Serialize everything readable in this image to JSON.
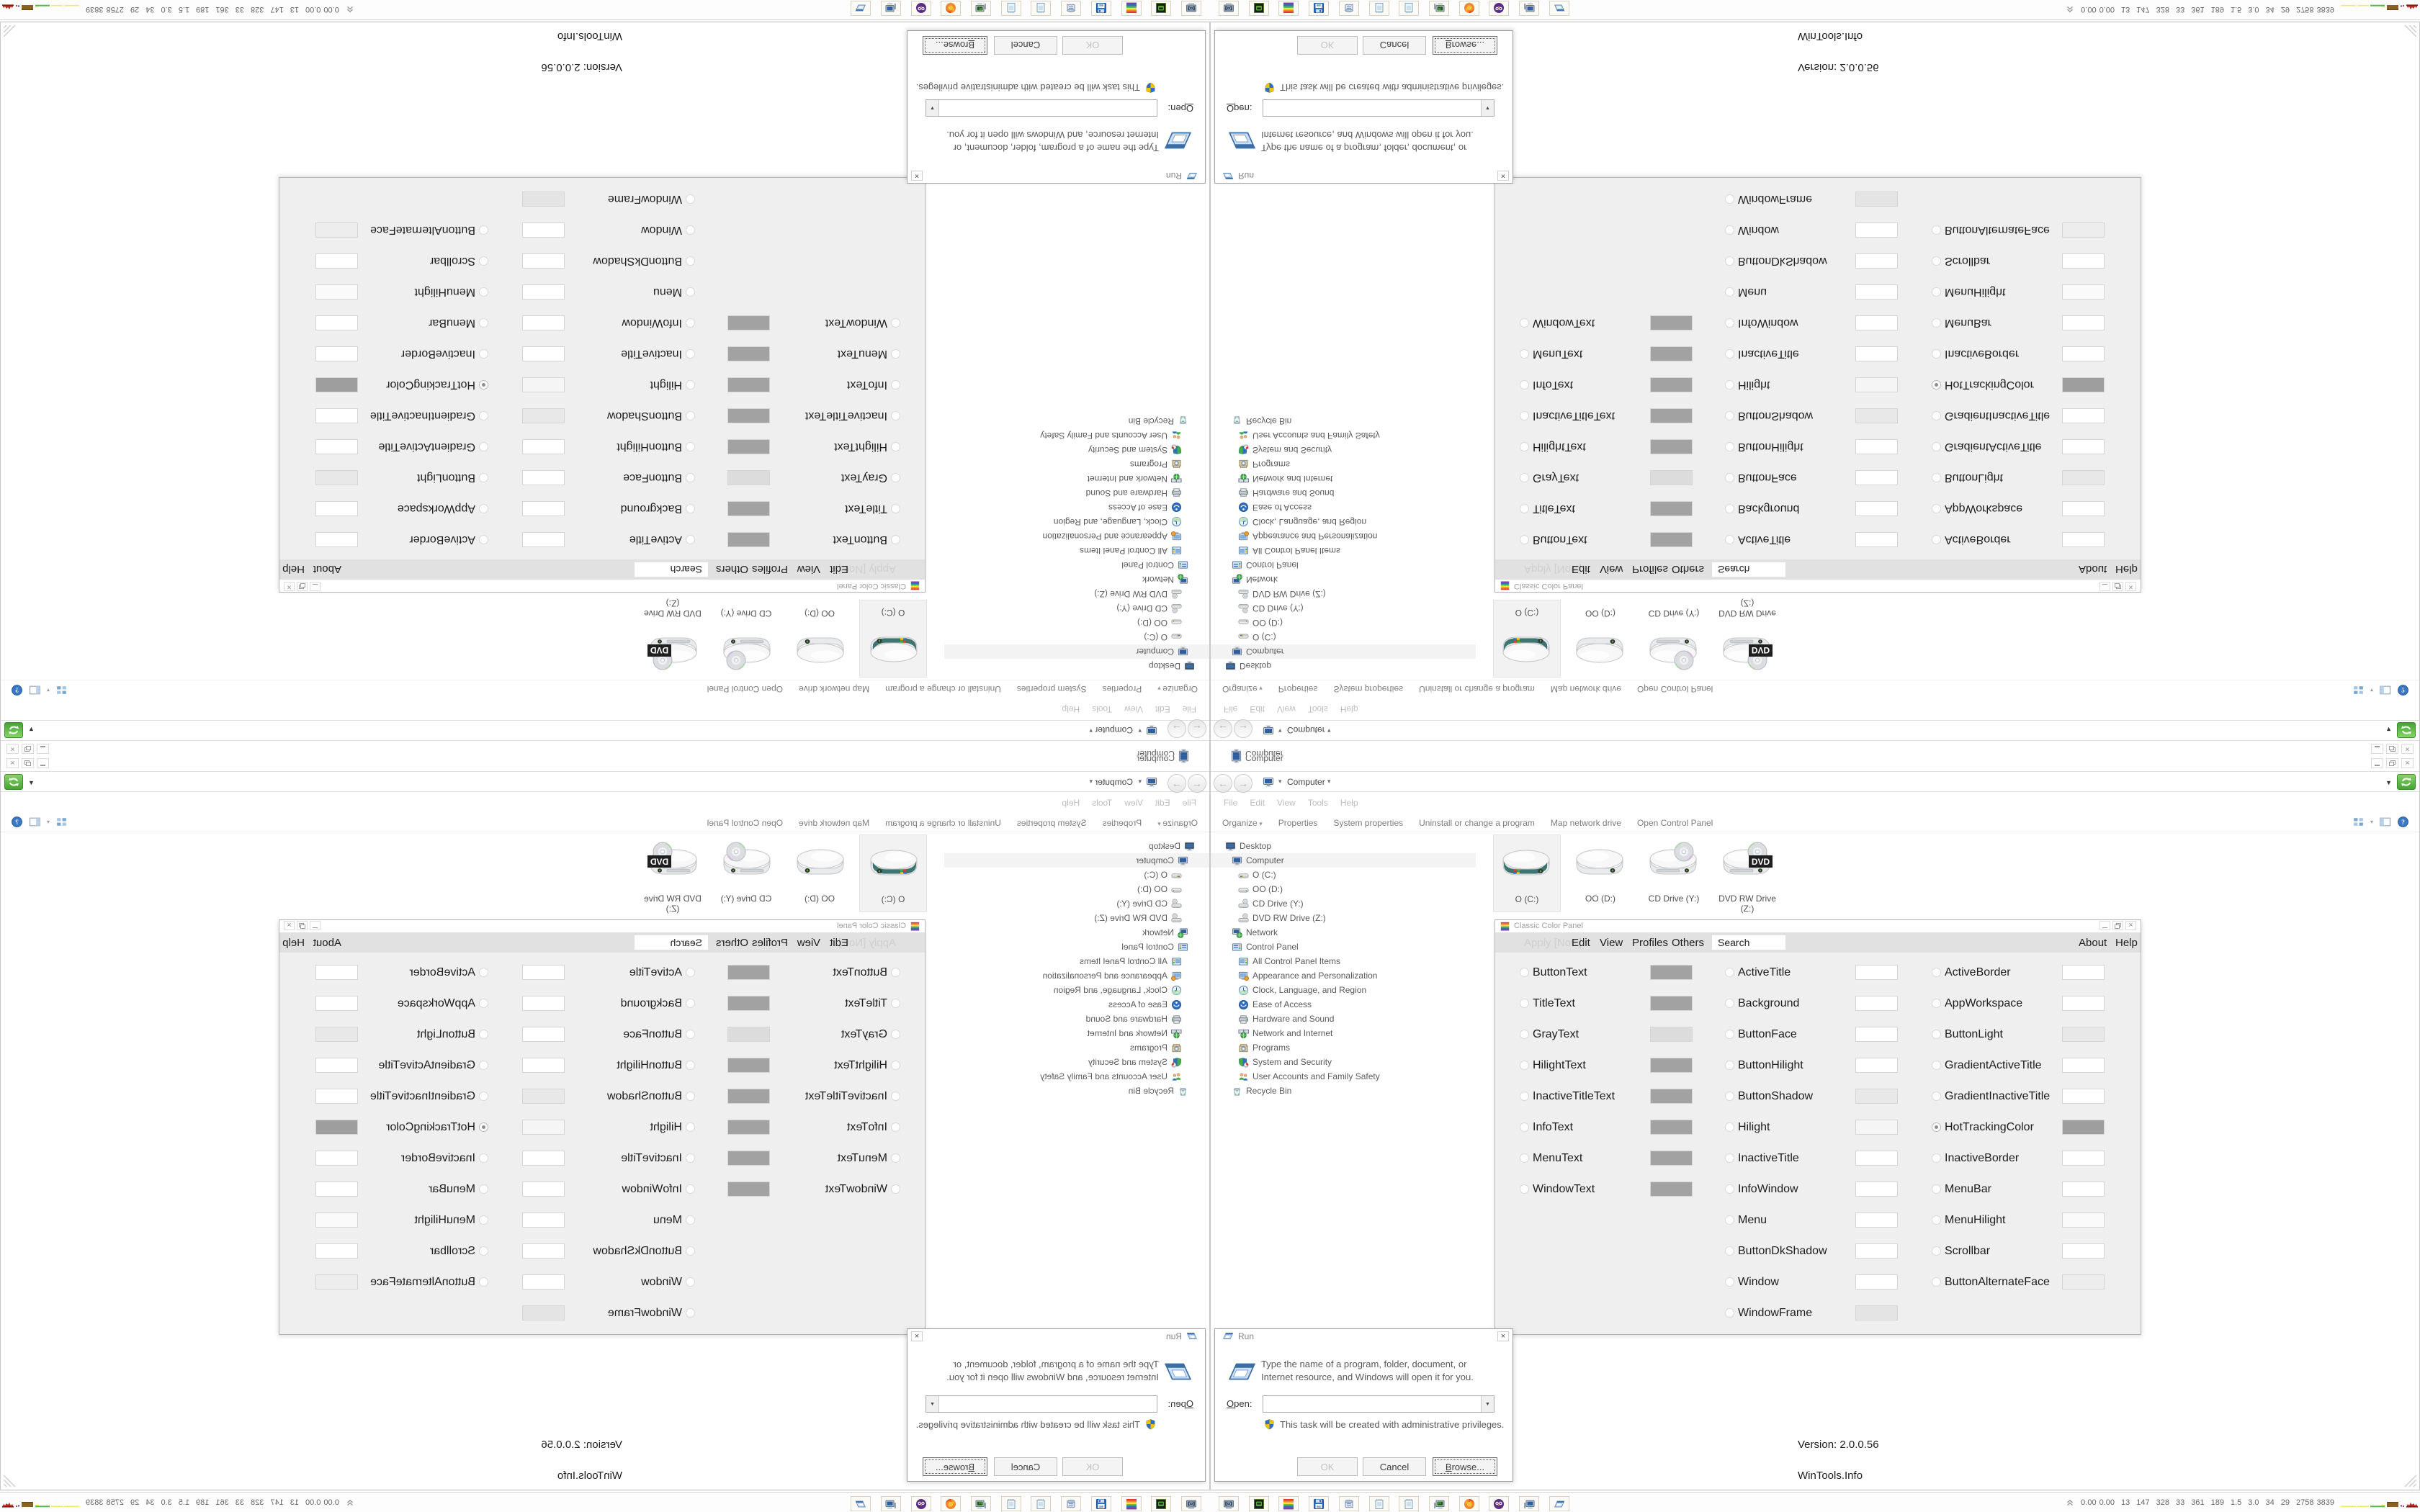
{
  "explorer": {
    "clipped_item": {
      "label": "Computer",
      "icon": "computer"
    },
    "caption_buttons": [
      "minimize",
      "restore",
      "close"
    ],
    "address_bar": {
      "breadcrumb": "Computer",
      "root_icon": "computer",
      "caret": "▾",
      "dropdown": "▼",
      "refresh_icon": "refresh"
    },
    "menu_items": [
      "File",
      "Edit",
      "View",
      "Tools",
      "Help"
    ],
    "command_items": [
      "Organize",
      "Properties",
      "System properties",
      "Uninstall or change a program",
      "Map network drive",
      "Open Control Panel"
    ],
    "command_right_icons": [
      "views-icon",
      "preview-pane-icon",
      "help-icon"
    ],
    "tree": [
      {
        "label": "Desktop",
        "level": 0,
        "icon": "desktop",
        "selected": false
      },
      {
        "label": "Computer",
        "level": 1,
        "icon": "computer",
        "selected": true
      },
      {
        "label": "O (C:)",
        "level": 2,
        "icon": "drive-windows",
        "selected": false
      },
      {
        "label": "OO (D:)",
        "level": 2,
        "icon": "drive",
        "selected": false
      },
      {
        "label": "CD Drive (Y:)",
        "level": 2,
        "icon": "drive-disc",
        "selected": false
      },
      {
        "label": "DVD RW Drive (Z:)",
        "level": 2,
        "icon": "drive-disc",
        "selected": false
      },
      {
        "label": "Network",
        "level": 1,
        "icon": "network",
        "selected": false
      },
      {
        "label": "Control Panel",
        "level": 1,
        "icon": "control-panel",
        "selected": false
      },
      {
        "label": "All Control Panel Items",
        "level": 2,
        "icon": "control-panel",
        "selected": false
      },
      {
        "label": "Appearance and Personalization",
        "level": 2,
        "icon": "appearance",
        "selected": false
      },
      {
        "label": "Clock, Language, and Region",
        "level": 2,
        "icon": "clock",
        "selected": false
      },
      {
        "label": "Ease of Access",
        "level": 2,
        "icon": "ease",
        "selected": false
      },
      {
        "label": "Hardware and Sound",
        "level": 2,
        "icon": "hardware",
        "selected": false
      },
      {
        "label": "Network and Internet",
        "level": 2,
        "icon": "network-internet",
        "selected": false
      },
      {
        "label": "Programs",
        "level": 2,
        "icon": "programs",
        "selected": false
      },
      {
        "label": "System and Security",
        "level": 2,
        "icon": "security",
        "selected": false
      },
      {
        "label": "User Accounts and Family Safety",
        "level": 2,
        "icon": "users",
        "selected": false
      },
      {
        "label": "Recycle Bin",
        "level": 1,
        "icon": "recycle-bin",
        "selected": false
      }
    ],
    "drives": [
      {
        "label": "O (C:)",
        "icon": "drive-large-windows",
        "selected": true
      },
      {
        "label": "OO (D:)",
        "icon": "drive-large",
        "selected": false
      },
      {
        "label": "CD Drive (Y:)",
        "icon": "drive-large-cd",
        "selected": false
      },
      {
        "label": "DVD RW Drive (Z:)",
        "icon": "drive-large-dvd",
        "selected": false
      }
    ]
  },
  "ccp": {
    "title": "Classic Color Panel",
    "app_icon": "color-panel",
    "menu": {
      "apply": "Apply [Now]",
      "items": [
        "Edit",
        "View",
        "Profiles",
        "Others"
      ],
      "search_value": "Search",
      "about": "About",
      "help": "Help"
    },
    "version": "Version: 2.0.0.56",
    "vendor": "WinTools.Info",
    "col1": [
      {
        "label": "ButtonText",
        "color": "#a2a2a2",
        "selected": false
      },
      {
        "label": "TitleText",
        "color": "#a2a2a2",
        "selected": false
      },
      {
        "label": "GrayText",
        "color": "#dcdcdc",
        "selected": false
      },
      {
        "label": "HilightText",
        "color": "#a2a2a2",
        "selected": false
      },
      {
        "label": "InactiveTitleText",
        "color": "#a2a2a2",
        "selected": false
      },
      {
        "label": "InfoText",
        "color": "#a2a2a2",
        "selected": false
      },
      {
        "label": "MenuText",
        "color": "#a2a2a2",
        "selected": false
      },
      {
        "label": "WindowText",
        "color": "#a2a2a2",
        "selected": false
      }
    ],
    "col2": [
      {
        "label": "ActiveTitle",
        "color": "#ffffff",
        "selected": false
      },
      {
        "label": "Background",
        "color": "#ffffff",
        "selected": false
      },
      {
        "label": "ButtonFace",
        "color": "#ffffff",
        "selected": false
      },
      {
        "label": "ButtonHilight",
        "color": "#ffffff",
        "selected": false
      },
      {
        "label": "ButtonShadow",
        "color": "#e8e8e8",
        "selected": false
      },
      {
        "label": "Hilight",
        "color": "#f5f5f5",
        "selected": false
      },
      {
        "label": "InactiveTitle",
        "color": "#ffffff",
        "selected": false
      },
      {
        "label": "InfoWindow",
        "color": "#ffffff",
        "selected": false
      },
      {
        "label": "Menu",
        "color": "#ffffff",
        "selected": false
      },
      {
        "label": "ButtonDkShadow",
        "color": "#ffffff",
        "selected": false
      },
      {
        "label": "Window",
        "color": "#ffffff",
        "selected": false
      },
      {
        "label": "WindowFrame",
        "color": "#e4e4e4",
        "selected": false
      }
    ],
    "col3": [
      {
        "label": "ActiveBorder",
        "color": "#ffffff",
        "selected": false
      },
      {
        "label": "AppWorkspace",
        "color": "#ffffff",
        "selected": false
      },
      {
        "label": "ButtonLight",
        "color": "#e8e8e8",
        "selected": false
      },
      {
        "label": "GradientActiveTitle",
        "color": "#ffffff",
        "selected": false
      },
      {
        "label": "GradientInactiveTitle",
        "color": "#ffffff",
        "selected": false
      },
      {
        "label": "HotTrackingColor",
        "color": "#9e9e9e",
        "selected": true
      },
      {
        "label": "InactiveBorder",
        "color": "#ffffff",
        "selected": false
      },
      {
        "label": "MenuBar",
        "color": "#ffffff",
        "selected": false
      },
      {
        "label": "MenuHilight",
        "color": "#fafafa",
        "selected": false
      },
      {
        "label": "Scrollbar",
        "color": "#ffffff",
        "selected": false
      },
      {
        "label": "ButtonAlternateFace",
        "color": "#ededed",
        "selected": false
      }
    ]
  },
  "run_dialog": {
    "title": "Run",
    "app_icon": "run-glyph",
    "message": "Type the name of a program, folder, document, or Internet resource, and Windows will open it for you.",
    "open_label": "Open:",
    "open_value": "",
    "admin_note": "This task will be created with administrative privileges.",
    "buttons": [
      {
        "label": "OK",
        "disabled": true,
        "focused": false
      },
      {
        "label": "Cancel",
        "disabled": false,
        "focused": false
      },
      {
        "label": "Browse...",
        "disabled": false,
        "focused": true
      }
    ]
  },
  "taskbar": {
    "buttons": [
      {
        "icon": "screenshot-tool"
      },
      {
        "icon": "console"
      },
      {
        "icon": "color-panel"
      },
      {
        "icon": "floppy-64"
      },
      {
        "icon": "scroll-printer"
      },
      {
        "icon": "notepad"
      },
      {
        "icon": "notepad"
      },
      {
        "icon": "pc-green"
      },
      {
        "icon": "firefox"
      },
      {
        "icon": "owl"
      },
      {
        "icon": "pc-blue"
      },
      {
        "icon": "run-glyph"
      }
    ],
    "tray": {
      "expand_icon": "chevron-up-double",
      "values": [
        "0.00",
        "0.00",
        "13",
        "147",
        "328",
        "33",
        "361",
        "189",
        "1.5",
        "3.0",
        "34",
        "29",
        "2758",
        "3839"
      ],
      "sparkline": {
        "yellow": "#f0ec62",
        "green": "#54b84a",
        "brown": "#8a6023",
        "brown_dark": "#6d4a15",
        "purple": "#6a3fa0",
        "red": "#b5271c",
        "red_dark": "#7e1a12"
      }
    }
  }
}
